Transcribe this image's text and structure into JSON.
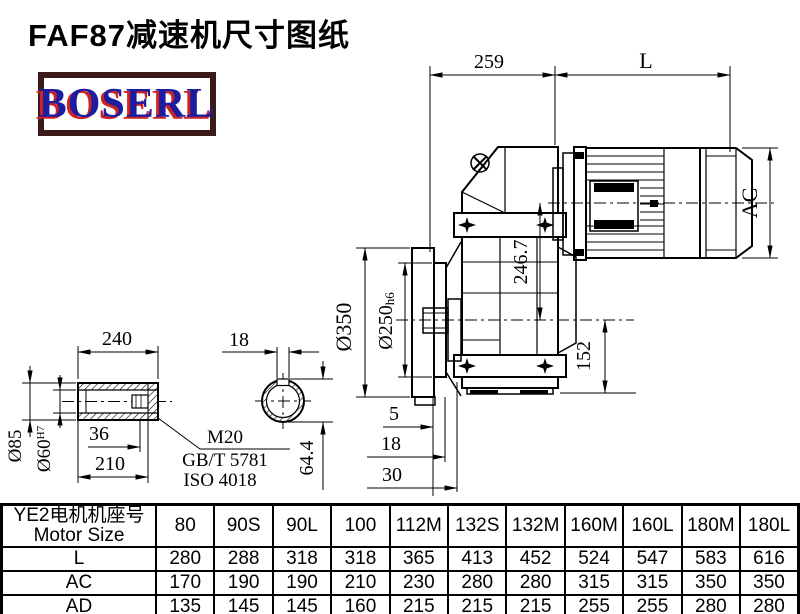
{
  "page": {
    "title": "FAF87减速机尺寸图纸"
  },
  "logo": {
    "text": "BOSERL",
    "text_color": "#1c1ca0",
    "shadow_color": "#cc2222",
    "border_color": "#3a1a1a"
  },
  "drawing": {
    "dims": {
      "top_width": "259",
      "motor_length": "L",
      "motor_diameter": "AC",
      "axis_distance": "246.7",
      "axis_to_base": "152",
      "flange_diameter": "Ø350",
      "spigot_diameter": "Ø250",
      "spigot_tolerance": "h6",
      "face_offset_a": "5",
      "face_offset_b": "18",
      "face_offset_c": "30",
      "shaft_length": "240",
      "shaft_od": "Ø85",
      "bore_diameter": "Ø60",
      "bore_tolerance": "H7",
      "keyway_to_end": "36",
      "hub_length": "210",
      "keyway_width": "18",
      "keyway_height": "64.4",
      "thread_spec": "M20",
      "thread_standard_gb": "GB/T 5781",
      "thread_standard_iso": "ISO 4018"
    }
  },
  "table": {
    "header_cn": "YE2电机机座号",
    "header_en": "Motor Size",
    "columns": [
      "80",
      "90S",
      "90L",
      "100",
      "112M",
      "132S",
      "132M",
      "160M",
      "160L",
      "180M",
      "180L"
    ],
    "rows": [
      {
        "label": "L",
        "values": [
          "280",
          "288",
          "318",
          "318",
          "365",
          "413",
          "452",
          "524",
          "547",
          "583",
          "616"
        ]
      },
      {
        "label": "AC",
        "values": [
          "170",
          "190",
          "190",
          "210",
          "230",
          "280",
          "280",
          "315",
          "315",
          "350",
          "350"
        ]
      },
      {
        "label": "AD",
        "values": [
          "135",
          "145",
          "145",
          "160",
          "215",
          "215",
          "215",
          "255",
          "255",
          "280",
          "280"
        ]
      }
    ]
  }
}
